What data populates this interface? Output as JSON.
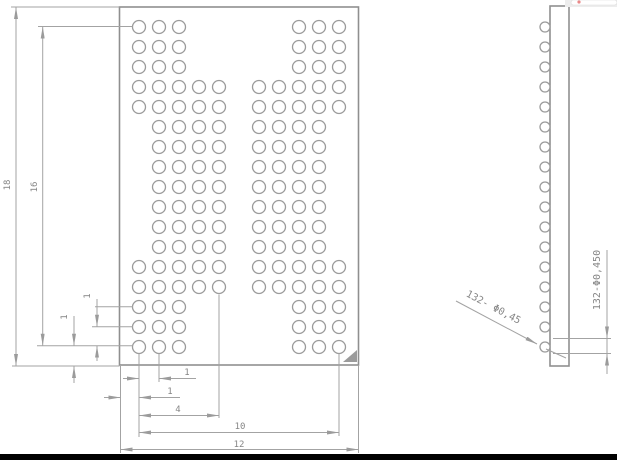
{
  "drawing_title": "BGA package ball-map engineering drawing",
  "colors": {
    "background": "#ffffff",
    "line": "#a3a3a3",
    "outline": "#8f8f8f",
    "text": "#868686",
    "corner_marker": "#9b9b9b",
    "bottom_bar": "#000000",
    "ui_fragment_bg": "#ededed",
    "ui_fragment_dot": "#e57373"
  },
  "front_view": {
    "first_col_x": 139,
    "pitch_px": 20,
    "ball_radius_px": 6.5,
    "ball_count": 132,
    "rows": [
      {
        "y": 27,
        "cols": [
          1,
          2,
          3,
          9,
          10,
          11
        ]
      },
      {
        "y": 47,
        "cols": [
          1,
          2,
          3,
          9,
          10,
          11
        ]
      },
      {
        "y": 67,
        "cols": [
          1,
          2,
          3,
          9,
          10,
          11
        ]
      },
      {
        "y": 87,
        "cols": [
          1,
          2,
          3,
          4,
          5,
          7,
          8,
          9,
          10,
          11
        ]
      },
      {
        "y": 107,
        "cols": [
          1,
          2,
          3,
          4,
          5,
          7,
          8,
          9,
          10,
          11
        ]
      },
      {
        "y": 127,
        "cols": [
          2,
          3,
          4,
          5,
          7,
          8,
          9,
          10
        ]
      },
      {
        "y": 147,
        "cols": [
          2,
          3,
          4,
          5,
          7,
          8,
          9,
          10
        ]
      },
      {
        "y": 167,
        "cols": [
          2,
          3,
          4,
          5,
          7,
          8,
          9,
          10
        ]
      },
      {
        "y": 187,
        "cols": [
          2,
          3,
          4,
          5,
          7,
          8,
          9,
          10
        ]
      },
      {
        "y": 207,
        "cols": [
          2,
          3,
          4,
          5,
          7,
          8,
          9,
          10
        ]
      },
      {
        "y": 227,
        "cols": [
          2,
          3,
          4,
          5,
          7,
          8,
          9,
          10
        ]
      },
      {
        "y": 247,
        "cols": [
          2,
          3,
          4,
          5,
          7,
          8,
          9,
          10
        ]
      },
      {
        "y": 267,
        "cols": [
          1,
          2,
          3,
          4,
          5,
          7,
          8,
          9,
          10,
          11
        ]
      },
      {
        "y": 287,
        "cols": [
          1,
          2,
          3,
          4,
          5,
          7,
          8,
          9,
          10,
          11
        ]
      },
      {
        "y": 307,
        "cols": [
          1,
          2,
          3,
          9,
          10,
          11
        ]
      },
      {
        "y": 327,
        "cols": [
          1,
          2,
          3,
          9,
          10,
          11
        ]
      },
      {
        "y": 347,
        "cols": [
          1,
          2,
          3,
          9,
          10,
          11
        ]
      }
    ]
  },
  "side_view": {
    "ball_center_x": 545,
    "ball_radius_px": 5
  },
  "dimensions": {
    "overall_height": {
      "value": "18"
    },
    "ball_field_height": {
      "value": "16"
    },
    "row_pitch": {
      "value": "1"
    },
    "row_edge_gap": {
      "value": "1"
    },
    "col_pitch": {
      "value": "1"
    },
    "col_edge_gap": {
      "value": "1"
    },
    "four_column_span": {
      "value": "4"
    },
    "ball_field_width": {
      "value": "10"
    },
    "overall_width": {
      "value": "12"
    },
    "ball_spec_front": {
      "value": "132- Φ0,45"
    },
    "ball_spec_side": {
      "value": "132-Φ0,450"
    }
  }
}
